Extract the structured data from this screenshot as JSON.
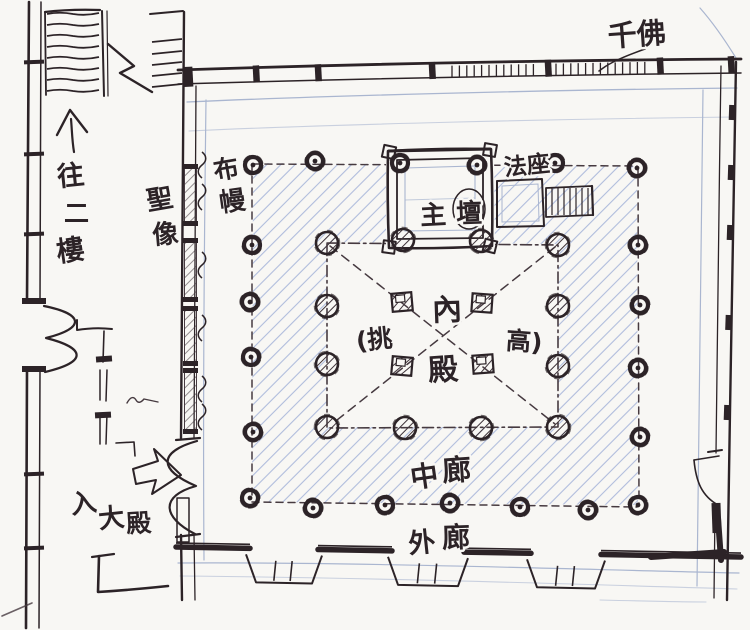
{
  "drawing": {
    "kind": "hand-drawn temple floor plan sketch (ink and blue pencil on paper)",
    "colors": {
      "ink": "#2c2327",
      "pencil_blue": "#a3b2d8",
      "paper": "#f8f7f4"
    },
    "labels": {
      "qianfo": "千佛",
      "to_second_floor": [
        "往",
        "二",
        "樓"
      ],
      "sacred_statues": [
        "聖",
        "像"
      ],
      "curtain": [
        "布",
        "幔"
      ],
      "main_altar": [
        "主",
        "壇"
      ],
      "dharma_seat": "法座",
      "inner_hall": [
        "內",
        "殿"
      ],
      "raised_ceiling": [
        "(挑",
        "高)"
      ],
      "middle_corridor": [
        "中",
        "廊"
      ],
      "outer_corridor": [
        "外",
        "廊"
      ],
      "enter_main_hall": [
        "入",
        "大",
        "殿"
      ]
    }
  }
}
